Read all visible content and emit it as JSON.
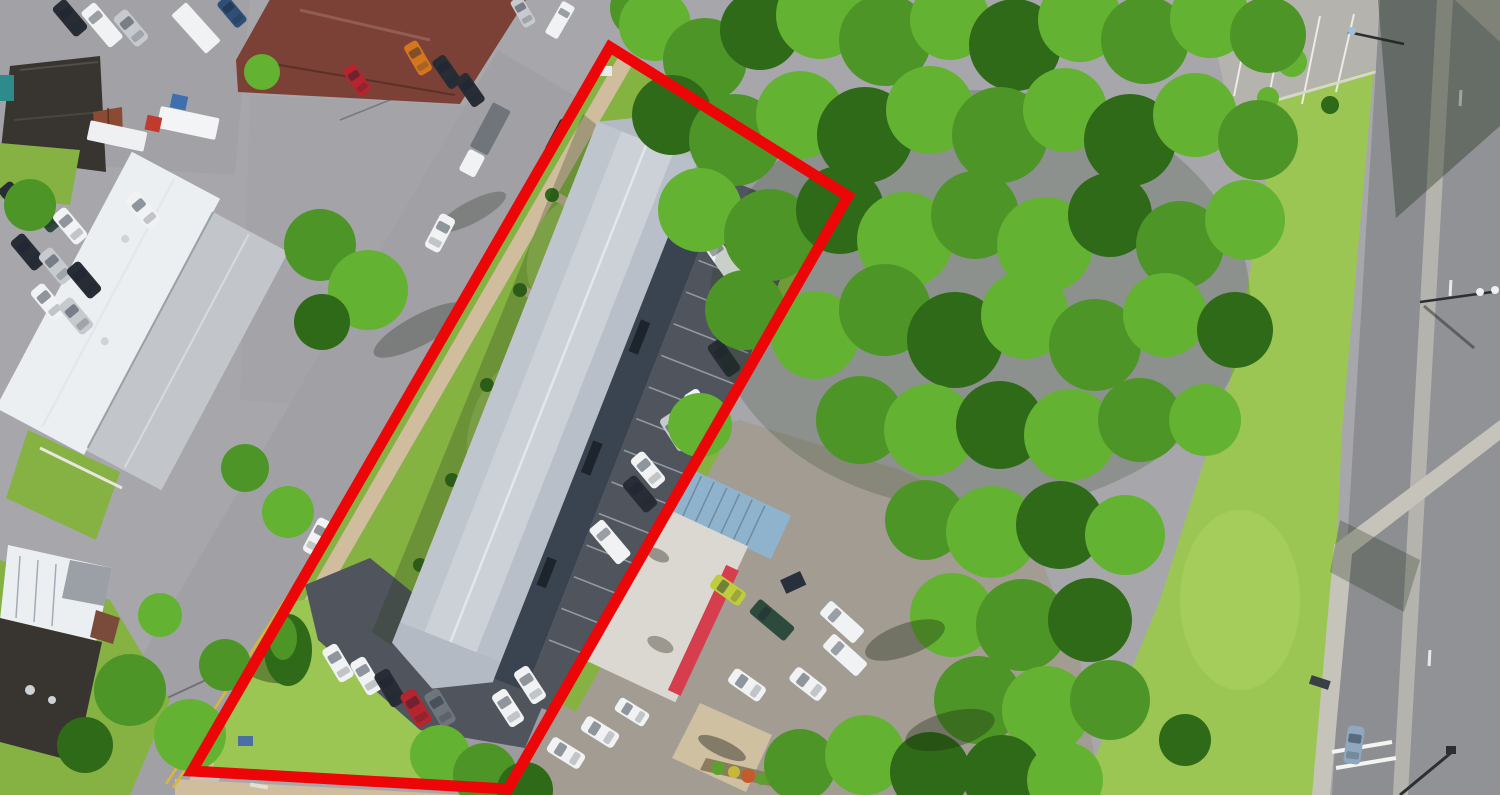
{
  "scene": {
    "title": "Aerial drone photograph of a commercial property outlined with a red parcel boundary",
    "type": "aerial-photograph",
    "description": "Overhead view: a long gray hip-roofed commercial building with landscaped walkways and an angled parking strip sits inside a red-outlined lot; a street with double yellow lines runs along the left, industrial buildings and truck yards occupy the upper left, a white flat-roofed restaurant with a red awning and blue metal canopy sits to the right of the parcel, a dense green tree grove fills the right-center, and a divided boulevard with grass verges, sidewalk and crosswalk runs down the right edge.",
    "boundary": {
      "color": "#ec0608",
      "stroke_width": 11,
      "points": "610,47 848,196 508,789 192,771"
    },
    "palette": {
      "pave": "#a7a7ab",
      "road": "#a1a1a5",
      "concrete": "#c6c3ba",
      "concrete2": "#b5b3ad",
      "walk": "#d0bd9d",
      "grass": "#85b242",
      "grass-bright": "#a3cc5e",
      "lawn": "#9cc653",
      "asphalt": "#50545c",
      "tree": "#4d9527",
      "tree-light": "#63b231",
      "tree-dark": "#2e6a17",
      "roof-light": "#ccd1d8",
      "roof-mid": "#b3bac4",
      "wall-dark": "#3a4450",
      "white-roof": "#eceff1",
      "gray-roof": "#c2c6cb",
      "brown-roof": "#7b4036",
      "dark-roof": "#38342f",
      "restaurant-roof": "#dbd8d2",
      "awning": "#d63d4d",
      "canopy": "#8fb3cd",
      "pad": "#cfc0a2",
      "yellow-line": "#d8b63a",
      "boundary": "#ec0608",
      "shadow": "rgba(25,40,18,0.35)"
    }
  }
}
